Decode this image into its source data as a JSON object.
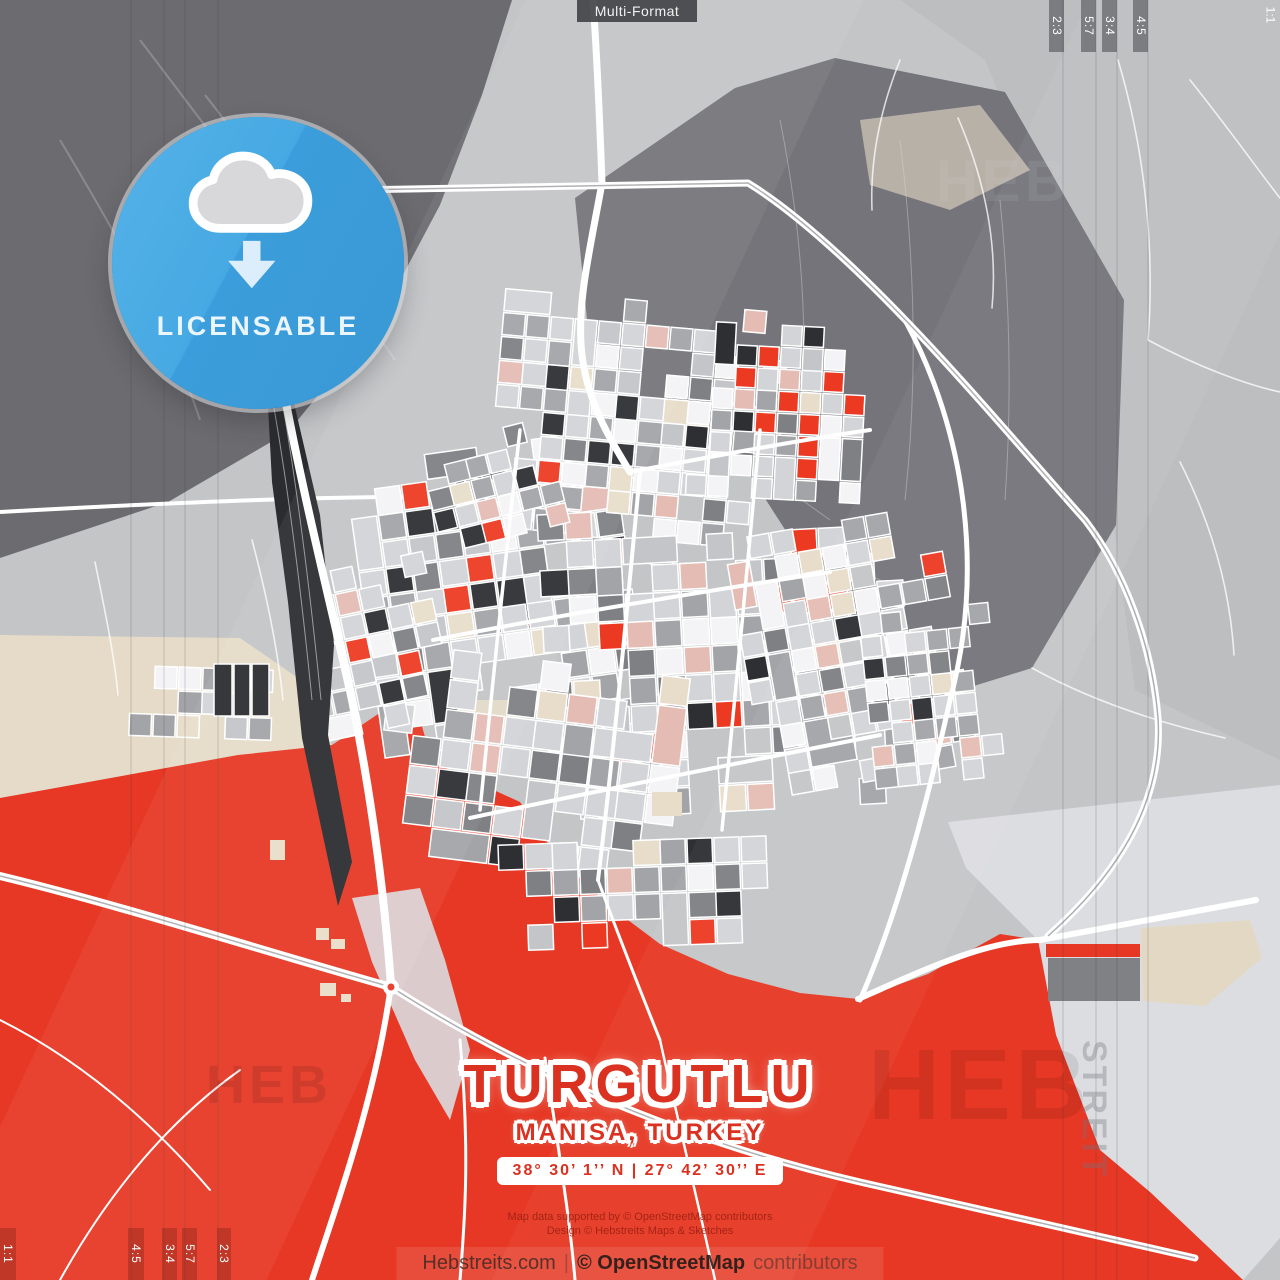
{
  "header": {
    "format_label": "Multi-Format"
  },
  "ratios": {
    "top_right": [
      "2:3",
      "5:7",
      "3:4",
      "4:5"
    ],
    "corner_top_right": "1:1",
    "bottom_left_corner": "1:1",
    "bottom_left": [
      "4:5",
      "3:4",
      "5:7",
      "2:3"
    ]
  },
  "badge": {
    "label": "LICENSABLE",
    "icon": "cloud-download-icon",
    "color": "#41a5e0"
  },
  "title_block": {
    "city": "TURGUTLU",
    "region": "MANISA, TURKEY",
    "coordinates": "38° 30’ 1’’ N | 27° 42’ 30’’ E"
  },
  "credits": {
    "line1": "Map data supported by © OpenStreetMap contributors",
    "line2": "Design © Hebstreits Maps & Sketches"
  },
  "attribution": {
    "site": "Hebstreits.com",
    "separator": "|",
    "osm": "© OpenStreetMap",
    "suffix": "contributors"
  },
  "watermarks": {
    "heb": "HEB",
    "streit": "STREIT"
  },
  "colors": {
    "accent_red": "#e63824",
    "badge_blue": "#41a5e0",
    "map_dark_grey": "#6d6d72",
    "map_base_grey": "#c3c5c7",
    "marker_text": "#ffffff"
  }
}
